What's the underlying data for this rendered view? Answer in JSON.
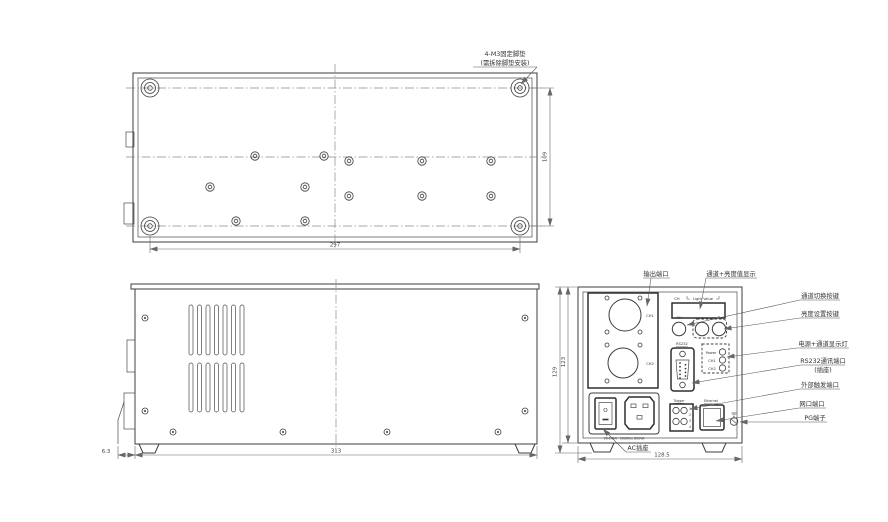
{
  "note": {
    "line1": "4-M3固定脚垫",
    "line2": "(需拆除脚垫安装)"
  },
  "dims": {
    "bottom_width": "297",
    "bottom_height": "109",
    "side_length": "313",
    "side_foot": "6.3",
    "rear_height_total": "129",
    "rear_height_body": "123",
    "rear_width": "128.5"
  },
  "rear": {
    "display_ch": "CH",
    "display_value": "Light Value",
    "knob_ch": "CH",
    "knob_minus": "-",
    "knob_plus": "+",
    "out_ch1": "CH1",
    "out_ch2": "CH2",
    "rs232": "RS232",
    "ind_power": "Power",
    "ind_ch1": "CH1",
    "ind_ch2": "CH2",
    "trigger": "Trigger",
    "pin1": "1",
    "pin2": "2",
    "pin3": "3",
    "pin4": "4",
    "ethernet": "Ethernet",
    "switch_o": "O",
    "ac_rating": "90-240V~50/60Hz 800VA"
  },
  "callouts": {
    "output_port": "输出端口",
    "display": "通道+亮度值显示",
    "channel_switch": "通道切换按键",
    "brightness_set": "亮度设置按键",
    "indicator": "电源+通道显示灯",
    "rs232_line1": "RS232通讯端口",
    "rs232_line2": "(插座)",
    "trigger": "外部触发端口",
    "lan": "网口端口",
    "pg": "PG端子",
    "ac": "AC插座"
  }
}
